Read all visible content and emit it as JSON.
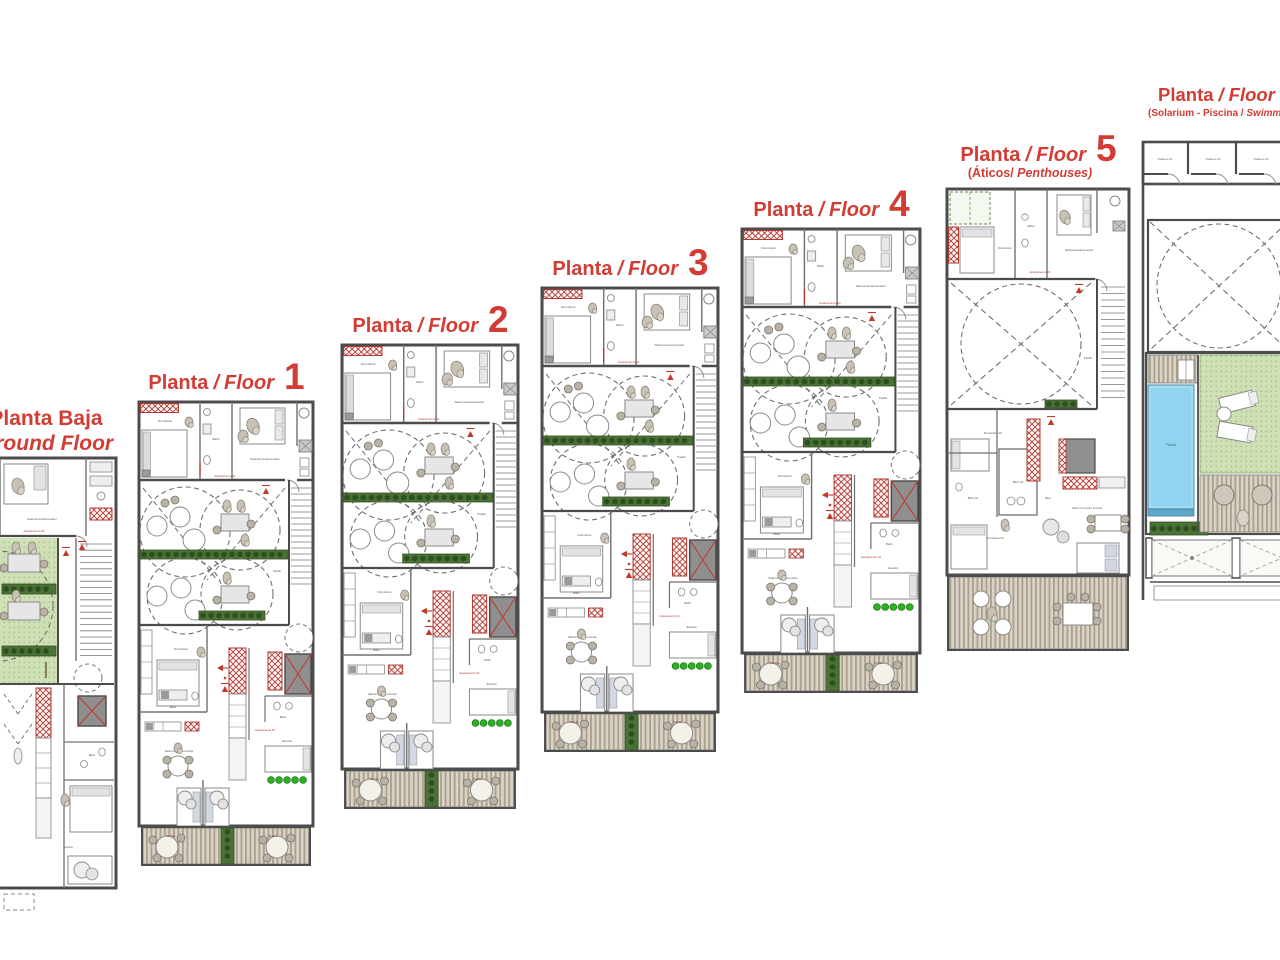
{
  "sheet": {
    "background": "#ffffff",
    "title_color": "#d23c34"
  },
  "floors": [
    {
      "id": "ground",
      "type": "ground",
      "line1": "Planta Baja",
      "line2": "Ground Floor"
    },
    {
      "id": "f1",
      "type": "standard",
      "planta": "Planta",
      "sep": "/",
      "floor_word": "Floor",
      "number": "1"
    },
    {
      "id": "f2",
      "type": "standard",
      "planta": "Planta",
      "sep": "/",
      "floor_word": "Floor",
      "number": "2"
    },
    {
      "id": "f3",
      "type": "standard",
      "planta": "Planta",
      "sep": "/",
      "floor_word": "Floor",
      "number": "3"
    },
    {
      "id": "f4",
      "type": "standard",
      "planta": "Planta",
      "sep": "/",
      "floor_word": "Floor",
      "number": "4"
    },
    {
      "id": "f5",
      "type": "penthouse",
      "planta": "Planta",
      "sep": "/",
      "floor_word": "Floor",
      "number": "5",
      "subtitle_plain": "(Áticos/",
      "subtitle_italic": " Penthouses)"
    },
    {
      "id": "f6",
      "type": "solarium",
      "planta": "Planta",
      "sep": "/",
      "floor_word": "Floor",
      "subtitle_plain": "(Solarium - Piscina /",
      "subtitle_italic": " Swimming Pool)"
    }
  ],
  "labels": {
    "dormitorio": "Dormitorio",
    "bano": "Baño",
    "salon_cocina": "Salón/cocina/comedor",
    "salon_mesas": "Salón/mesas/comedor",
    "apartamento1": "Apartamento 01",
    "apartamento2": "Apartamento 02",
    "estudio": "Estudio",
    "pasillo": "Pasillo",
    "porche": "Porche",
    "cocina": "Cocina",
    "piscina": "Piscina",
    "paso": "Paso",
    "salon_comedor": "Salón Comedor Cocina",
    "dormitorio1": "Dormitorio 01",
    "dormitorio2": "Dormitorio 02",
    "bano1": "Baño 01",
    "bano2": "Baño 02",
    "trastero21": "Trastero 21",
    "trastero20": "Trastero 20",
    "trastero19": "Trastero 19"
  },
  "colors": {
    "wall": "#4c4c4c",
    "inner_wall": "#707070",
    "red_accent": "#b03a32",
    "red_symbol": "#c0392b",
    "green_strip": "#4a7136",
    "green_shrub": "#2fae25",
    "lawn": "#cfe0b6",
    "deck_light": "#d9d3c6",
    "deck_dark": "#ab9f8e",
    "pool": "#92d4f0",
    "porche_label": "#7e2c26"
  }
}
